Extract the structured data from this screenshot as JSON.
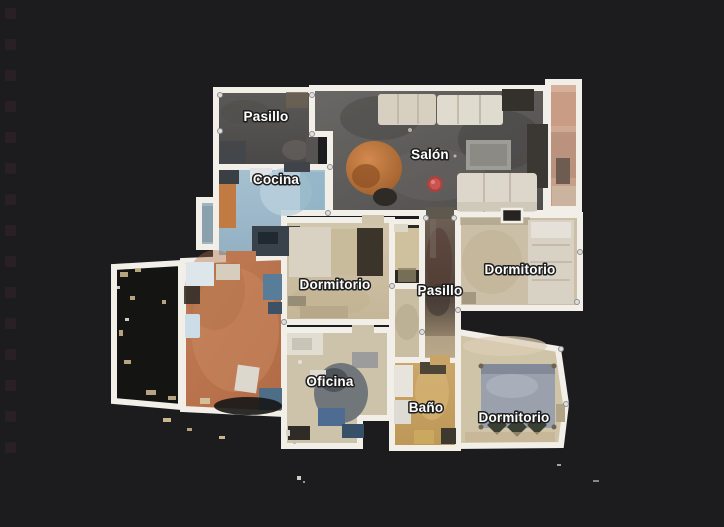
{
  "app": {
    "view_name": "floorplan-top-view",
    "background_color": "#1c1c1f",
    "wall_color": "#f2efe9"
  },
  "rooms": [
    {
      "id": "pasillo-top",
      "label": "Pasillo"
    },
    {
      "id": "salon",
      "label": "Salón"
    },
    {
      "id": "cocina",
      "label": "Cocina"
    },
    {
      "id": "dormitorio-left",
      "label": "Dormitorio"
    },
    {
      "id": "pasillo-center",
      "label": "Pasillo"
    },
    {
      "id": "dormitorio-right",
      "label": "Dormitorio"
    },
    {
      "id": "oficina",
      "label": "Oficina"
    },
    {
      "id": "bano",
      "label": "Baño"
    },
    {
      "id": "dormitorio-bottom",
      "label": "Dormitorio"
    }
  ],
  "marker": {
    "type": "current-position",
    "color": "#c84b47"
  }
}
